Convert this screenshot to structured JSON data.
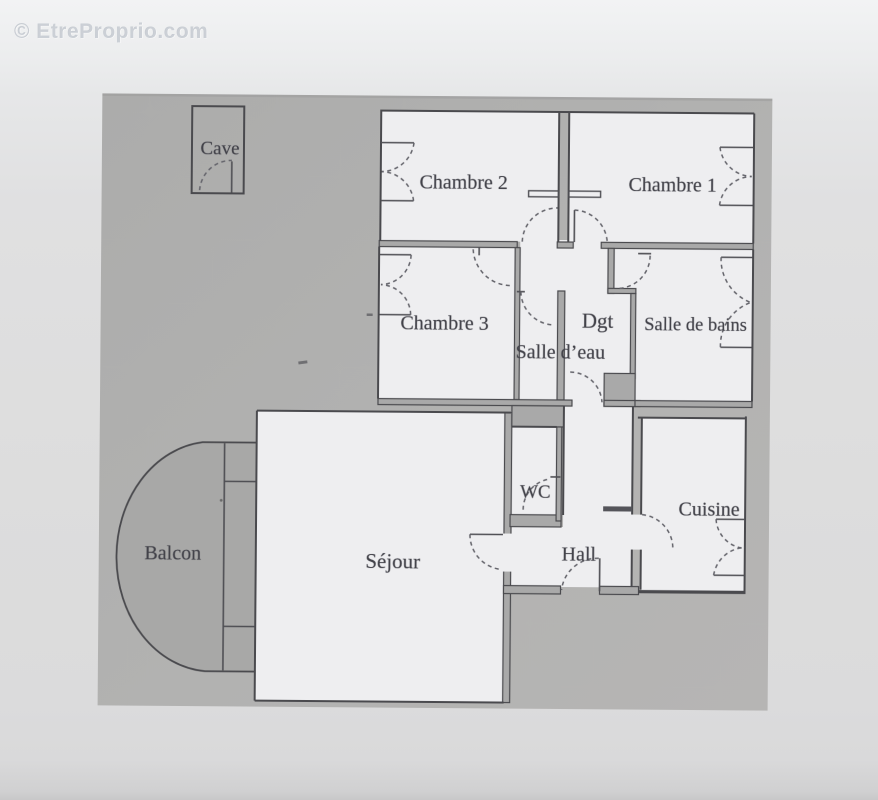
{
  "watermark": {
    "text": "© EtreProprio.com"
  },
  "floorplan": {
    "rooms": {
      "cave": {
        "label": "Cave"
      },
      "chambre2": {
        "label": "Chambre 2"
      },
      "chambre1": {
        "label": "Chambre 1"
      },
      "chambre3": {
        "label": "Chambre 3"
      },
      "dgt": {
        "label": "Dgt"
      },
      "salle_deau": {
        "label": "Salle d’eau"
      },
      "salle_de_bains": {
        "label": "Salle de bains"
      },
      "wc": {
        "label": "WC"
      },
      "hall": {
        "label": "Hall"
      },
      "cuisine": {
        "label": "Cuisine"
      },
      "sejour": {
        "label": "Séjour"
      },
      "balcon": {
        "label": "Balcon"
      }
    },
    "colors": {
      "plan_background": "#b0b0b0",
      "room_fill": "#eeeef0",
      "balcony_fill": "#a8a8a7",
      "wall_line": "#4a4a4e",
      "label_text": "#43434a",
      "page_background": "#dcdcdd",
      "watermark_text": "#a5acb6"
    }
  }
}
